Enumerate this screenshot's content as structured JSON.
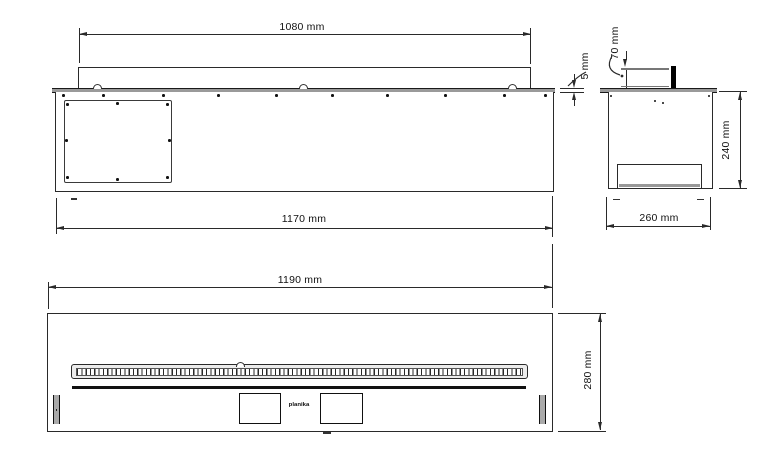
{
  "dims": {
    "front_top_width": "1080 mm",
    "front_body_width": "1170 mm",
    "flange_thickness": "5 mm",
    "burner_offset": "70 mm",
    "side_height": "240 mm",
    "side_depth": "260 mm",
    "plan_width": "1190 mm",
    "plan_depth": "280 mm"
  },
  "logo_text": "planika",
  "colors": {
    "line": "#2a2a2a",
    "flange_fill": "#9a9a9a",
    "solid_black": "#111111",
    "background": "#ffffff"
  }
}
